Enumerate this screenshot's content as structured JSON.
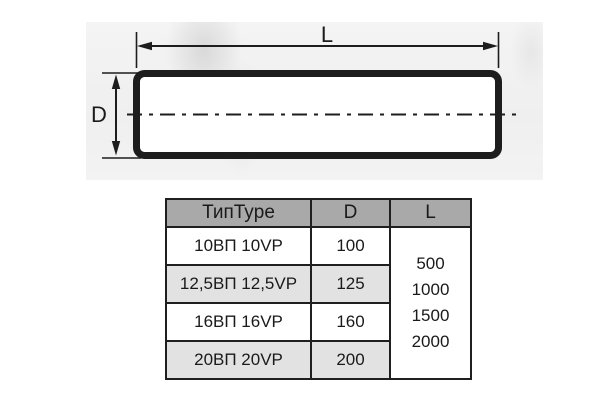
{
  "diagram": {
    "length_label": "L",
    "diameter_label": "D"
  },
  "table": {
    "headers": {
      "type": "ТипType",
      "d": "D",
      "l": "L"
    },
    "rows": [
      {
        "type": "10ВП 10VP",
        "d": "100"
      },
      {
        "type": "12,5ВП 12,5VP",
        "d": "125"
      },
      {
        "type": "16ВП 16VP",
        "d": "160"
      },
      {
        "type": "20ВП 20VP",
        "d": "200"
      }
    ],
    "l_values": [
      "500",
      "1000",
      "1500",
      "2000"
    ]
  },
  "colors": {
    "line": "#1d1d1d",
    "header_bg": "#a9a9a9",
    "alt_row_bg": "#e2e2e2",
    "table_border": "#1f1f1f",
    "text": "#1a1a1a"
  }
}
